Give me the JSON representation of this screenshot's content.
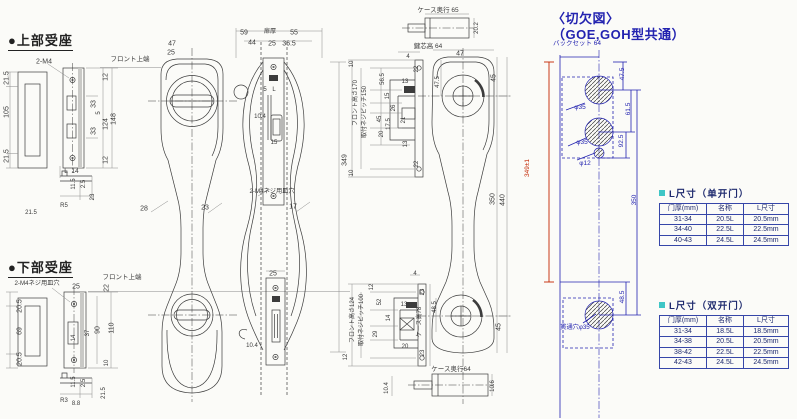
{
  "colors": {
    "ink": "#3a3a3a",
    "blue": "#2323b0",
    "red": "#c22500",
    "cyan": "#3fc6c6",
    "table_border": "#3646a8",
    "table_text": "#1e2a6e"
  },
  "sections": {
    "upper_seat_label": "●上部受座",
    "lower_seat_label": "●下部受座",
    "cutout_title_line1": "〈切欠図〉",
    "cutout_title_line2": "（GOE,GOH型共通）"
  },
  "annotations": [
    {
      "t": "2-M4",
      "x": 44,
      "y": 62
    },
    {
      "t": "フロント上端",
      "x": 130,
      "y": 60,
      "s": 6.5
    },
    {
      "t": "47",
      "x": 172,
      "y": 44
    },
    {
      "t": "25",
      "x": 171,
      "y": 53
    },
    {
      "t": "21.5",
      "x": 7,
      "y": 78,
      "r": -90
    },
    {
      "t": "105",
      "x": 7,
      "y": 112,
      "r": -90
    },
    {
      "t": "21.5",
      "x": 7,
      "y": 156,
      "r": -90
    },
    {
      "t": "12",
      "x": 106,
      "y": 77,
      "r": -90
    },
    {
      "t": "33",
      "x": 94,
      "y": 104,
      "r": -90
    },
    {
      "t": "5",
      "x": 99,
      "y": 113,
      "r": -90,
      "s": 6
    },
    {
      "t": "124",
      "x": 106,
      "y": 124,
      "r": -90
    },
    {
      "t": "148",
      "x": 114,
      "y": 119,
      "r": -90
    },
    {
      "t": "33",
      "x": 94,
      "y": 131,
      "r": -90
    },
    {
      "t": "12",
      "x": 106,
      "y": 160,
      "r": -90
    },
    {
      "t": "L",
      "x": 66,
      "y": 172,
      "s": 6.5
    },
    {
      "t": "14",
      "x": 75,
      "y": 172,
      "s": 6.5
    },
    {
      "t": "11.5",
      "x": 74,
      "y": 184,
      "r": -90,
      "s": 6
    },
    {
      "t": "2.5",
      "x": 84,
      "y": 184,
      "r": -90,
      "s": 6
    },
    {
      "t": "23",
      "x": 93,
      "y": 197,
      "r": -90,
      "s": 6
    },
    {
      "t": "R5",
      "x": 64,
      "y": 206,
      "s": 6
    },
    {
      "t": "21.5",
      "x": 31,
      "y": 213,
      "s": 6
    },
    {
      "t": "2-M4ネジ用皿穴",
      "x": 37,
      "y": 284,
      "s": 6.2
    },
    {
      "t": "フロント上端",
      "x": 122,
      "y": 278,
      "s": 6.5
    },
    {
      "t": "25",
      "x": 76,
      "y": 287
    },
    {
      "t": "22",
      "x": 107,
      "y": 288,
      "r": -90
    },
    {
      "t": "20.5",
      "x": 20,
      "y": 306,
      "r": -90
    },
    {
      "t": "69",
      "x": 20,
      "y": 331,
      "r": -90
    },
    {
      "t": "20.5",
      "x": 20,
      "y": 359,
      "r": -90
    },
    {
      "t": "14",
      "x": 74,
      "y": 338,
      "r": -90,
      "s": 6
    },
    {
      "t": "37",
      "x": 88,
      "y": 333,
      "r": -90,
      "s": 6
    },
    {
      "t": "90",
      "x": 98,
      "y": 330,
      "r": -90
    },
    {
      "t": "110",
      "x": 112,
      "y": 328,
      "r": -90
    },
    {
      "t": "10",
      "x": 107,
      "y": 363,
      "r": -90,
      "s": 6
    },
    {
      "t": "11.5",
      "x": 74,
      "y": 382,
      "r": -90,
      "s": 6
    },
    {
      "t": "2.5",
      "x": 84,
      "y": 383,
      "r": -90,
      "s": 6
    },
    {
      "t": "21.5",
      "x": 104,
      "y": 393,
      "r": -90,
      "s": 6
    },
    {
      "t": "R3",
      "x": 64,
      "y": 401,
      "s": 6
    },
    {
      "t": "8.8",
      "x": 76,
      "y": 404,
      "s": 6
    },
    {
      "t": "28",
      "x": 144,
      "y": 209
    },
    {
      "t": "59",
      "x": 244,
      "y": 33
    },
    {
      "t": "扉厚",
      "x": 270,
      "y": 32,
      "s": 6.2
    },
    {
      "t": "55",
      "x": 294,
      "y": 33
    },
    {
      "t": "44",
      "x": 252,
      "y": 43
    },
    {
      "t": "25",
      "x": 272,
      "y": 44
    },
    {
      "t": "36.5",
      "x": 289,
      "y": 44
    },
    {
      "t": "5",
      "x": 265,
      "y": 90,
      "s": 6
    },
    {
      "t": "L",
      "x": 274,
      "y": 90,
      "s": 6
    },
    {
      "t": "10.4",
      "x": 260,
      "y": 117,
      "s": 6
    },
    {
      "t": "15",
      "x": 274,
      "y": 143,
      "s": 6
    },
    {
      "t": "2-M4ネジ用皿穴",
      "x": 272,
      "y": 192,
      "s": 6.2
    },
    {
      "t": "23",
      "x": 205,
      "y": 208
    },
    {
      "t": "17",
      "x": 293,
      "y": 207
    },
    {
      "t": "25",
      "x": 273,
      "y": 274
    },
    {
      "t": "10.4",
      "x": 252,
      "y": 346,
      "s": 6
    },
    {
      "t": "349",
      "x": 345,
      "y": 160,
      "r": -90
    },
    {
      "t": "ケース奥行 65",
      "x": 438,
      "y": 11,
      "s": 6.5
    },
    {
      "t": "20.2",
      "x": 477,
      "y": 28,
      "r": -90,
      "s": 6
    },
    {
      "t": "鍵芯高 64",
      "x": 428,
      "y": 47,
      "s": 6.5
    },
    {
      "t": "4",
      "x": 408,
      "y": 57,
      "s": 6
    },
    {
      "t": "10",
      "x": 352,
      "y": 64,
      "r": -90,
      "s": 6
    },
    {
      "t": "22",
      "x": 417,
      "y": 69,
      "r": -90,
      "s": 6
    },
    {
      "t": "56.5",
      "x": 383,
      "y": 79,
      "r": -90,
      "s": 6
    },
    {
      "t": "13",
      "x": 405,
      "y": 82,
      "s": 6
    },
    {
      "t": "フロント高さ170",
      "x": 356,
      "y": 103,
      "r": -90,
      "s": 6
    },
    {
      "t": "取付ネジピッチ150",
      "x": 365,
      "y": 112,
      "r": -90,
      "s": 6
    },
    {
      "t": "15",
      "x": 388,
      "y": 96,
      "r": -90,
      "s": 6
    },
    {
      "t": "26",
      "x": 394,
      "y": 108,
      "r": -90,
      "s": 6
    },
    {
      "t": "45",
      "x": 380,
      "y": 119,
      "r": -90,
      "s": 6
    },
    {
      "t": "17.5",
      "x": 389,
      "y": 124,
      "r": -90,
      "s": 6
    },
    {
      "t": "20",
      "x": 382,
      "y": 134,
      "r": -90,
      "s": 6
    },
    {
      "t": "21",
      "x": 404,
      "y": 120,
      "r": -90,
      "s": 6
    },
    {
      "t": "13",
      "x": 406,
      "y": 144,
      "r": -90,
      "s": 6
    },
    {
      "t": "22",
      "x": 417,
      "y": 164,
      "r": -90,
      "s": 6
    },
    {
      "t": "10",
      "x": 352,
      "y": 173,
      "r": -90,
      "s": 6
    },
    {
      "t": "47",
      "x": 460,
      "y": 54
    },
    {
      "t": "47.5",
      "x": 438,
      "y": 82,
      "r": -90,
      "s": 6
    },
    {
      "t": "45",
      "x": 494,
      "y": 78,
      "r": -90
    },
    {
      "t": "350",
      "x": 493,
      "y": 199,
      "r": -90
    },
    {
      "t": "440",
      "x": 503,
      "y": 200,
      "r": -90
    },
    {
      "t": "45",
      "x": 499,
      "y": 327,
      "r": -90
    },
    {
      "t": "4",
      "x": 415,
      "y": 274,
      "s": 6
    },
    {
      "t": "12",
      "x": 372,
      "y": 287,
      "r": -90,
      "s": 6
    },
    {
      "t": "フロント高さ124",
      "x": 353,
      "y": 320,
      "r": -90,
      "s": 6
    },
    {
      "t": "取付ネジピッチ100",
      "x": 362,
      "y": 320,
      "r": -90,
      "s": 6
    },
    {
      "t": "52",
      "x": 380,
      "y": 302,
      "r": -90,
      "s": 6
    },
    {
      "t": "13",
      "x": 404,
      "y": 305,
      "s": 6
    },
    {
      "t": "14",
      "x": 389,
      "y": 318,
      "r": -90,
      "s": 6
    },
    {
      "t": "29",
      "x": 376,
      "y": 334,
      "r": -90,
      "s": 6
    },
    {
      "t": "20",
      "x": 405,
      "y": 347,
      "s": 6
    },
    {
      "t": "23",
      "x": 423,
      "y": 292,
      "r": -90,
      "s": 6
    },
    {
      "t": "48.5",
      "x": 435,
      "y": 307,
      "r": -90,
      "s": 6
    },
    {
      "t": "ケース高78",
      "x": 420,
      "y": 322,
      "r": -90,
      "s": 6
    },
    {
      "t": "23",
      "x": 423,
      "y": 353,
      "r": -90,
      "s": 6
    },
    {
      "t": "12",
      "x": 346,
      "y": 357,
      "r": -90,
      "s": 6
    },
    {
      "t": "ケース奥行64",
      "x": 451,
      "y": 370,
      "s": 6.5
    },
    {
      "t": "10.4",
      "x": 387,
      "y": 388,
      "r": -90,
      "s": 6
    },
    {
      "t": "10.6",
      "x": 493,
      "y": 386,
      "r": -90,
      "s": 6
    },
    {
      "t": "バックセット 64",
      "x": 577,
      "y": 44,
      "c": "b",
      "s": 6.5
    },
    {
      "t": "47.5",
      "x": 623,
      "y": 74,
      "r": -90,
      "c": "b",
      "s": 6.5
    },
    {
      "t": "φ35",
      "x": 580,
      "y": 108,
      "c": "b",
      "s": 6.5
    },
    {
      "t": "61.5",
      "x": 629,
      "y": 109,
      "r": -90,
      "c": "b",
      "s": 6.5
    },
    {
      "t": "92.5",
      "x": 622,
      "y": 141,
      "r": -90,
      "c": "b",
      "s": 6.5
    },
    {
      "t": "φ35",
      "x": 582,
      "y": 143,
      "c": "b",
      "s": 6.5
    },
    {
      "t": "φ12",
      "x": 585,
      "y": 164,
      "c": "b",
      "s": 6.5
    },
    {
      "t": "349±1",
      "x": 528,
      "y": 168,
      "r": -90,
      "c": "r",
      "s": 6.5
    },
    {
      "t": "350",
      "x": 635,
      "y": 200,
      "r": -90,
      "c": "b",
      "s": 6.5
    },
    {
      "t": "48.5",
      "x": 623,
      "y": 297,
      "r": -90,
      "c": "b",
      "s": 6.5
    },
    {
      "t": "貫通穴φ35",
      "x": 575,
      "y": 328,
      "c": "b",
      "s": 6.2
    }
  ],
  "tables": [
    {
      "title": "L尺寸（单开门）",
      "headers": [
        "门厚(mm)",
        "名称",
        "L尺寸"
      ],
      "rows": [
        [
          "31-34",
          "20.5L",
          "20.5mm"
        ],
        [
          "34-40",
          "22.5L",
          "22.5mm"
        ],
        [
          "40-43",
          "24.5L",
          "24.5mm"
        ]
      ]
    },
    {
      "title": "L尺寸（双开门）",
      "headers": [
        "门厚(mm)",
        "名称",
        "L尺寸"
      ],
      "rows": [
        [
          "31-34",
          "18.5L",
          "18.5mm"
        ],
        [
          "34-38",
          "20.5L",
          "20.5mm"
        ],
        [
          "38-42",
          "22.5L",
          "22.5mm"
        ],
        [
          "42-43",
          "24.5L",
          "24.5mm"
        ]
      ]
    }
  ]
}
